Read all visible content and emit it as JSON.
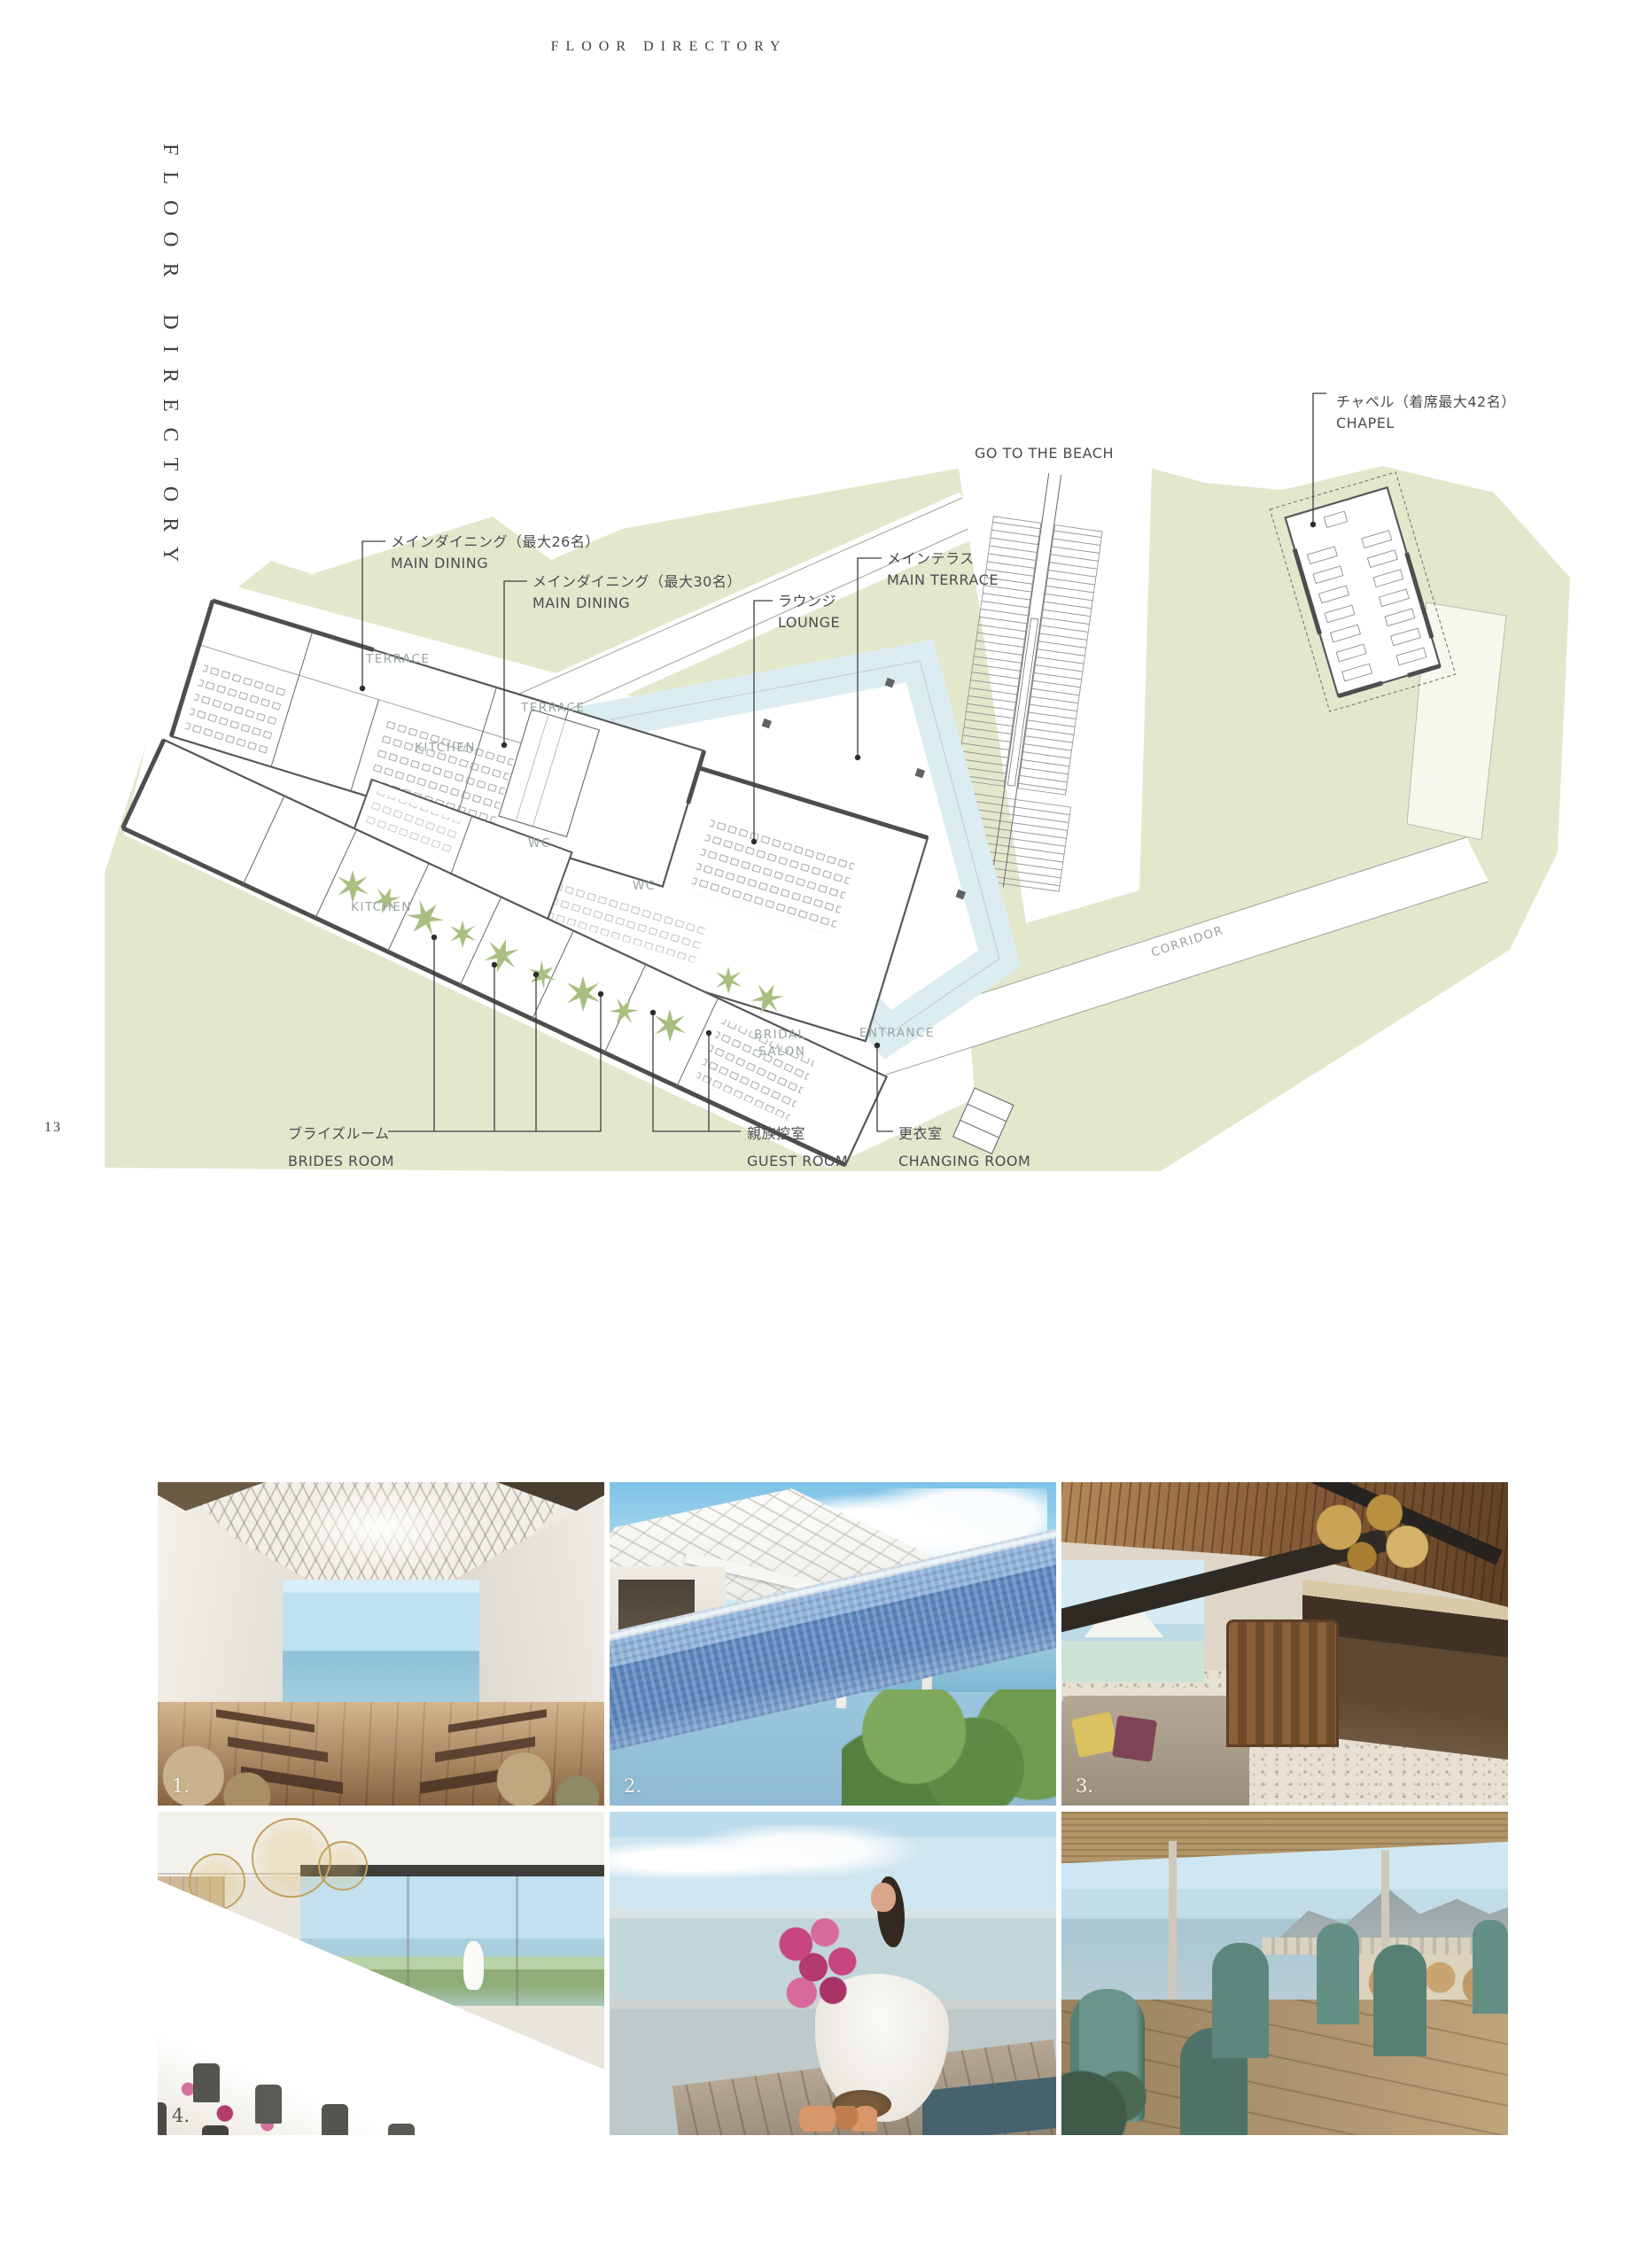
{
  "page": {
    "header_title": "FLOOR DIRECTORY",
    "side_title": "FLOOR DIRECTORY",
    "page_number": "13"
  },
  "map": {
    "labels": {
      "chapel_jp": "チャペル（着席最大42名）",
      "chapel_en": "CHAPEL",
      "beach": "GO TO THE BEACH",
      "dining26_jp": "メインダイニング（最大26名）",
      "dining26_en": "MAIN DINING",
      "dining30_jp": "メインダイニング（最大30名）",
      "dining30_en": "MAIN DINING",
      "terrace_jp": "メインテラス",
      "terrace_en": "MAIN TERRACE",
      "lounge_jp": "ラウンジ",
      "lounge_en": "LOUNGE",
      "brides_jp": "ブライズルーム",
      "brides_en": "BRIDES ROOM",
      "guest_jp": "親族控室",
      "guest_en": "GUEST ROOM",
      "changing_jp": "更衣室",
      "changing_en": "CHANGING ROOM"
    },
    "rooms": {
      "terrace1": "TERRACE",
      "terrace2": "TERRACE",
      "kitchen1": "KITCHEN",
      "kitchen2": "KITCHEN",
      "wc1": "WC",
      "wc2": "WC",
      "bridal1": "BRIDAL",
      "bridal2": "SALON",
      "entrance": "ENTRANCE",
      "corridor": "CORRIDOR"
    },
    "colors": {
      "land_green": "#e3e8cd",
      "pool_blue": "#dcedf2",
      "palm_green": "#a9bf82",
      "wall_gray": "#4d4f4e",
      "label_gray": "#4a4d50",
      "room_label_gray": "#9aa3a3"
    }
  },
  "photos": [
    {
      "name": "chapel-interior",
      "number": "1."
    },
    {
      "name": "pool-terrace",
      "number": "2."
    },
    {
      "name": "lounge-bar",
      "number": "3."
    },
    {
      "name": "party-room",
      "number": "4."
    },
    {
      "name": "bride-on-deck",
      "number": ""
    },
    {
      "name": "ocean-view-restaurant",
      "number": ""
    }
  ]
}
